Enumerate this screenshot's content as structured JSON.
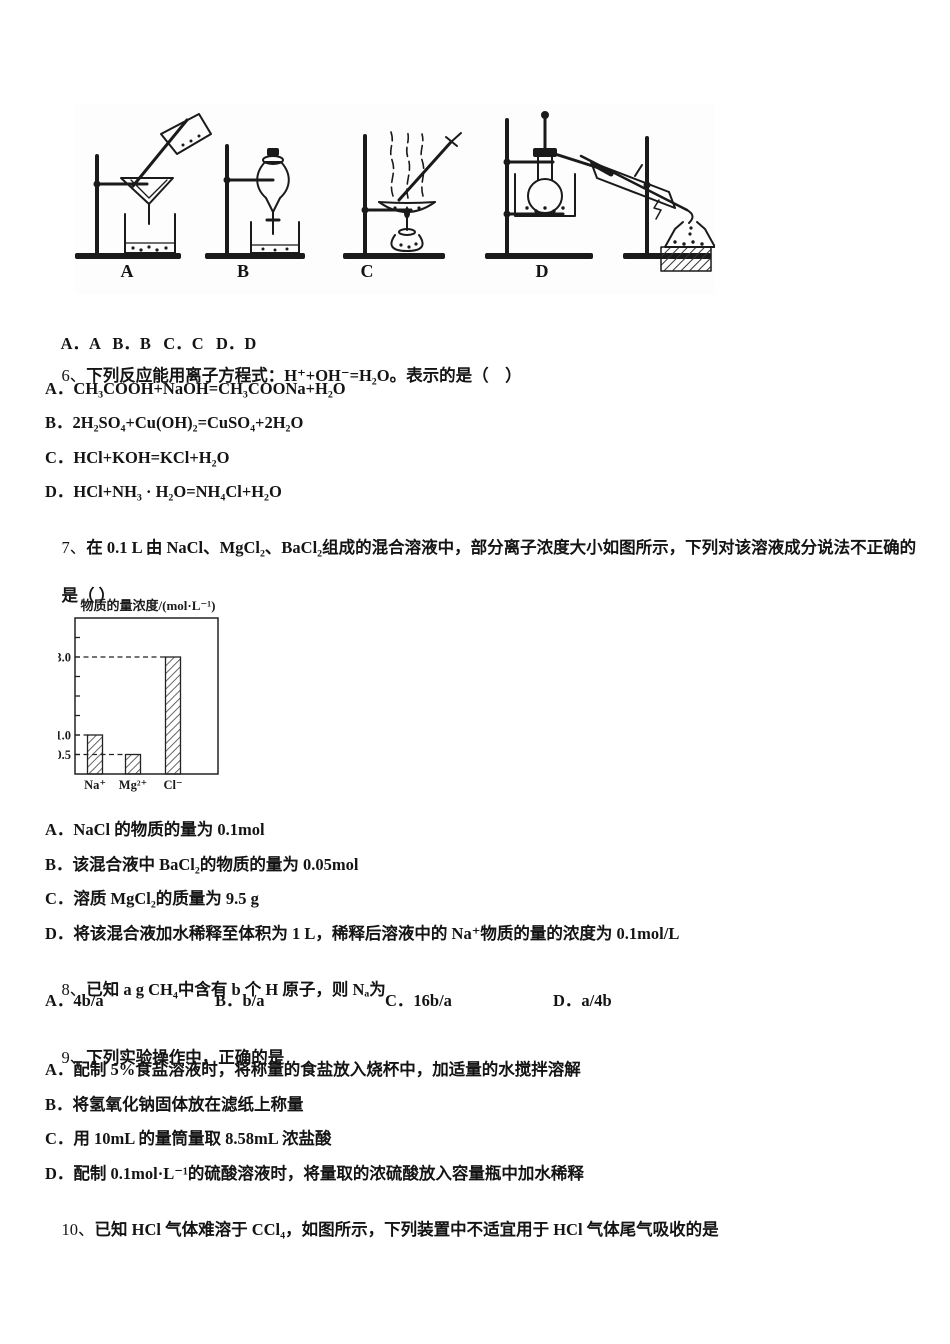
{
  "page": {
    "background": "#ffffff",
    "text_color": "#141414",
    "kind": "chemistry exam paper (Chinese), questions 5 answer line through 10"
  },
  "apparatus_figure": {
    "description": "four lab setups: A filtration, B separating funnel, C evaporation with heating, D distillation with condenser and receiver",
    "labels": [
      "A",
      "B",
      "C",
      "D"
    ]
  },
  "q5_answer_line": "A．A   B．B   C．C   D．D",
  "q6": {
    "number": "6、",
    "stem": "下列反应能用离子方程式：H⁺+OH⁻=H₂O。表示的是（　）",
    "options": [
      "A．CH₃COOH+NaOH=CH₃COONa+H₂O",
      "B．2H₂SO₄+Cu(OH)₂=CuSO₄+2H₂O",
      "C．HCl+KOH=KCl+H₂O",
      "D．HCl+NH₃ · H₂O=NH₄Cl+H₂O"
    ]
  },
  "q7": {
    "number": "7、",
    "stem_line1": "在 0.1 L 由 NaCl、MgCl₂、BaCl₂组成的混合溶液中，部分离子浓度大小如图所示，下列对该溶液成分说法不正确的",
    "stem_line2": "是（ ）",
    "options": [
      "A．NaCl 的物质的量为 0.1mol",
      "B．该混合液中 BaCl₂的物质的量为 0.05mol",
      "C．溶质 MgCl₂的质量为 9.5 g",
      "D．将该混合液加水稀释至体积为 1 L，稀释后溶液中的 Na⁺物质的量的浓度为 0.1mol/L"
    ]
  },
  "chart_data": {
    "type": "bar",
    "title": "物质的量浓度/(mol·L⁻¹)",
    "categories": [
      "Na⁺",
      "Mg²⁺",
      "Cl⁻"
    ],
    "values": [
      1.0,
      0.5,
      3.0
    ],
    "ylabel": "物质的量浓度/(mol·L⁻¹)",
    "xlabel": "",
    "ytick_labels": [
      "3.0",
      "1.0",
      "0.5"
    ],
    "ylim": [
      0,
      4
    ],
    "grid": false,
    "legend": "none",
    "style": "hatched bars, dashed guide lines from axis to each bar top"
  },
  "q8": {
    "number": "8、",
    "stem": "已知 a g CH₄中含有 b 个 H 原子，则 Nₐ为",
    "options": [
      "A．4b/a",
      "B．b/a",
      "C．16b/a",
      "D．a/4b"
    ]
  },
  "q9": {
    "number": "9、",
    "stem": "下列实验操作中，正确的是",
    "options": [
      "A．配制 5%食盐溶液时，将称量的食盐放入烧杯中，加适量的水搅拌溶解",
      "B．将氢氧化钠固体放在滤纸上称量",
      "C．用 10mL 的量筒量取 8.58mL 浓盐酸",
      "D．配制 0.1mol·L⁻¹的硫酸溶液时，将量取的浓硫酸放入容量瓶中加水稀释"
    ]
  },
  "q10": {
    "number": "10、",
    "stem": "已知 HCl 气体难溶于 CCl₄，如图所示，下列装置中不适宜用于 HCl 气体尾气吸收的是"
  }
}
